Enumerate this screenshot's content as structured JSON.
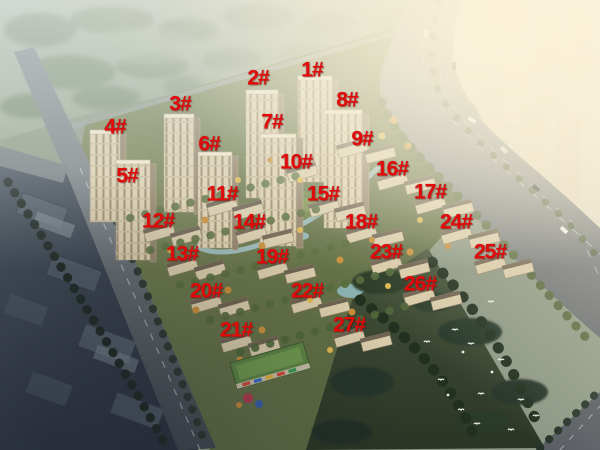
{
  "overlay": {
    "label_color": "#e20a0a",
    "labels": [
      {
        "text": "1#",
        "x": 312,
        "y": 70
      },
      {
        "text": "2#",
        "x": 258,
        "y": 78
      },
      {
        "text": "3#",
        "x": 180,
        "y": 104
      },
      {
        "text": "4#",
        "x": 115,
        "y": 127
      },
      {
        "text": "5#",
        "x": 127,
        "y": 176
      },
      {
        "text": "6#",
        "x": 209,
        "y": 144
      },
      {
        "text": "7#",
        "x": 272,
        "y": 122
      },
      {
        "text": "8#",
        "x": 347,
        "y": 100
      },
      {
        "text": "9#",
        "x": 362,
        "y": 139
      },
      {
        "text": "10#",
        "x": 296,
        "y": 162
      },
      {
        "text": "11#",
        "x": 222,
        "y": 194
      },
      {
        "text": "12#",
        "x": 158,
        "y": 221
      },
      {
        "text": "13#",
        "x": 182,
        "y": 254
      },
      {
        "text": "14#",
        "x": 249,
        "y": 222
      },
      {
        "text": "15#",
        "x": 323,
        "y": 194
      },
      {
        "text": "16#",
        "x": 392,
        "y": 169
      },
      {
        "text": "17#",
        "x": 430,
        "y": 192
      },
      {
        "text": "18#",
        "x": 361,
        "y": 222
      },
      {
        "text": "19#",
        "x": 272,
        "y": 257
      },
      {
        "text": "20#",
        "x": 206,
        "y": 291
      },
      {
        "text": "21#",
        "x": 236,
        "y": 330
      },
      {
        "text": "22#",
        "x": 307,
        "y": 291
      },
      {
        "text": "23#",
        "x": 386,
        "y": 252
      },
      {
        "text": "24#",
        "x": 456,
        "y": 222
      },
      {
        "text": "25#",
        "x": 490,
        "y": 252
      },
      {
        "text": "26#",
        "x": 420,
        "y": 284
      },
      {
        "text": "27#",
        "x": 349,
        "y": 325
      }
    ]
  },
  "scene": {
    "colors": {
      "meadow_green": "#9aa894",
      "lawn_green": "#6a7749",
      "park_dark_green": "#36422e",
      "road_grey": "#83878c",
      "dark_city_blue": "#3c4450",
      "building_beige": "#d9ccab",
      "warm_haze": "#f6ecd4",
      "water_blue": "#9cc3cc"
    }
  }
}
